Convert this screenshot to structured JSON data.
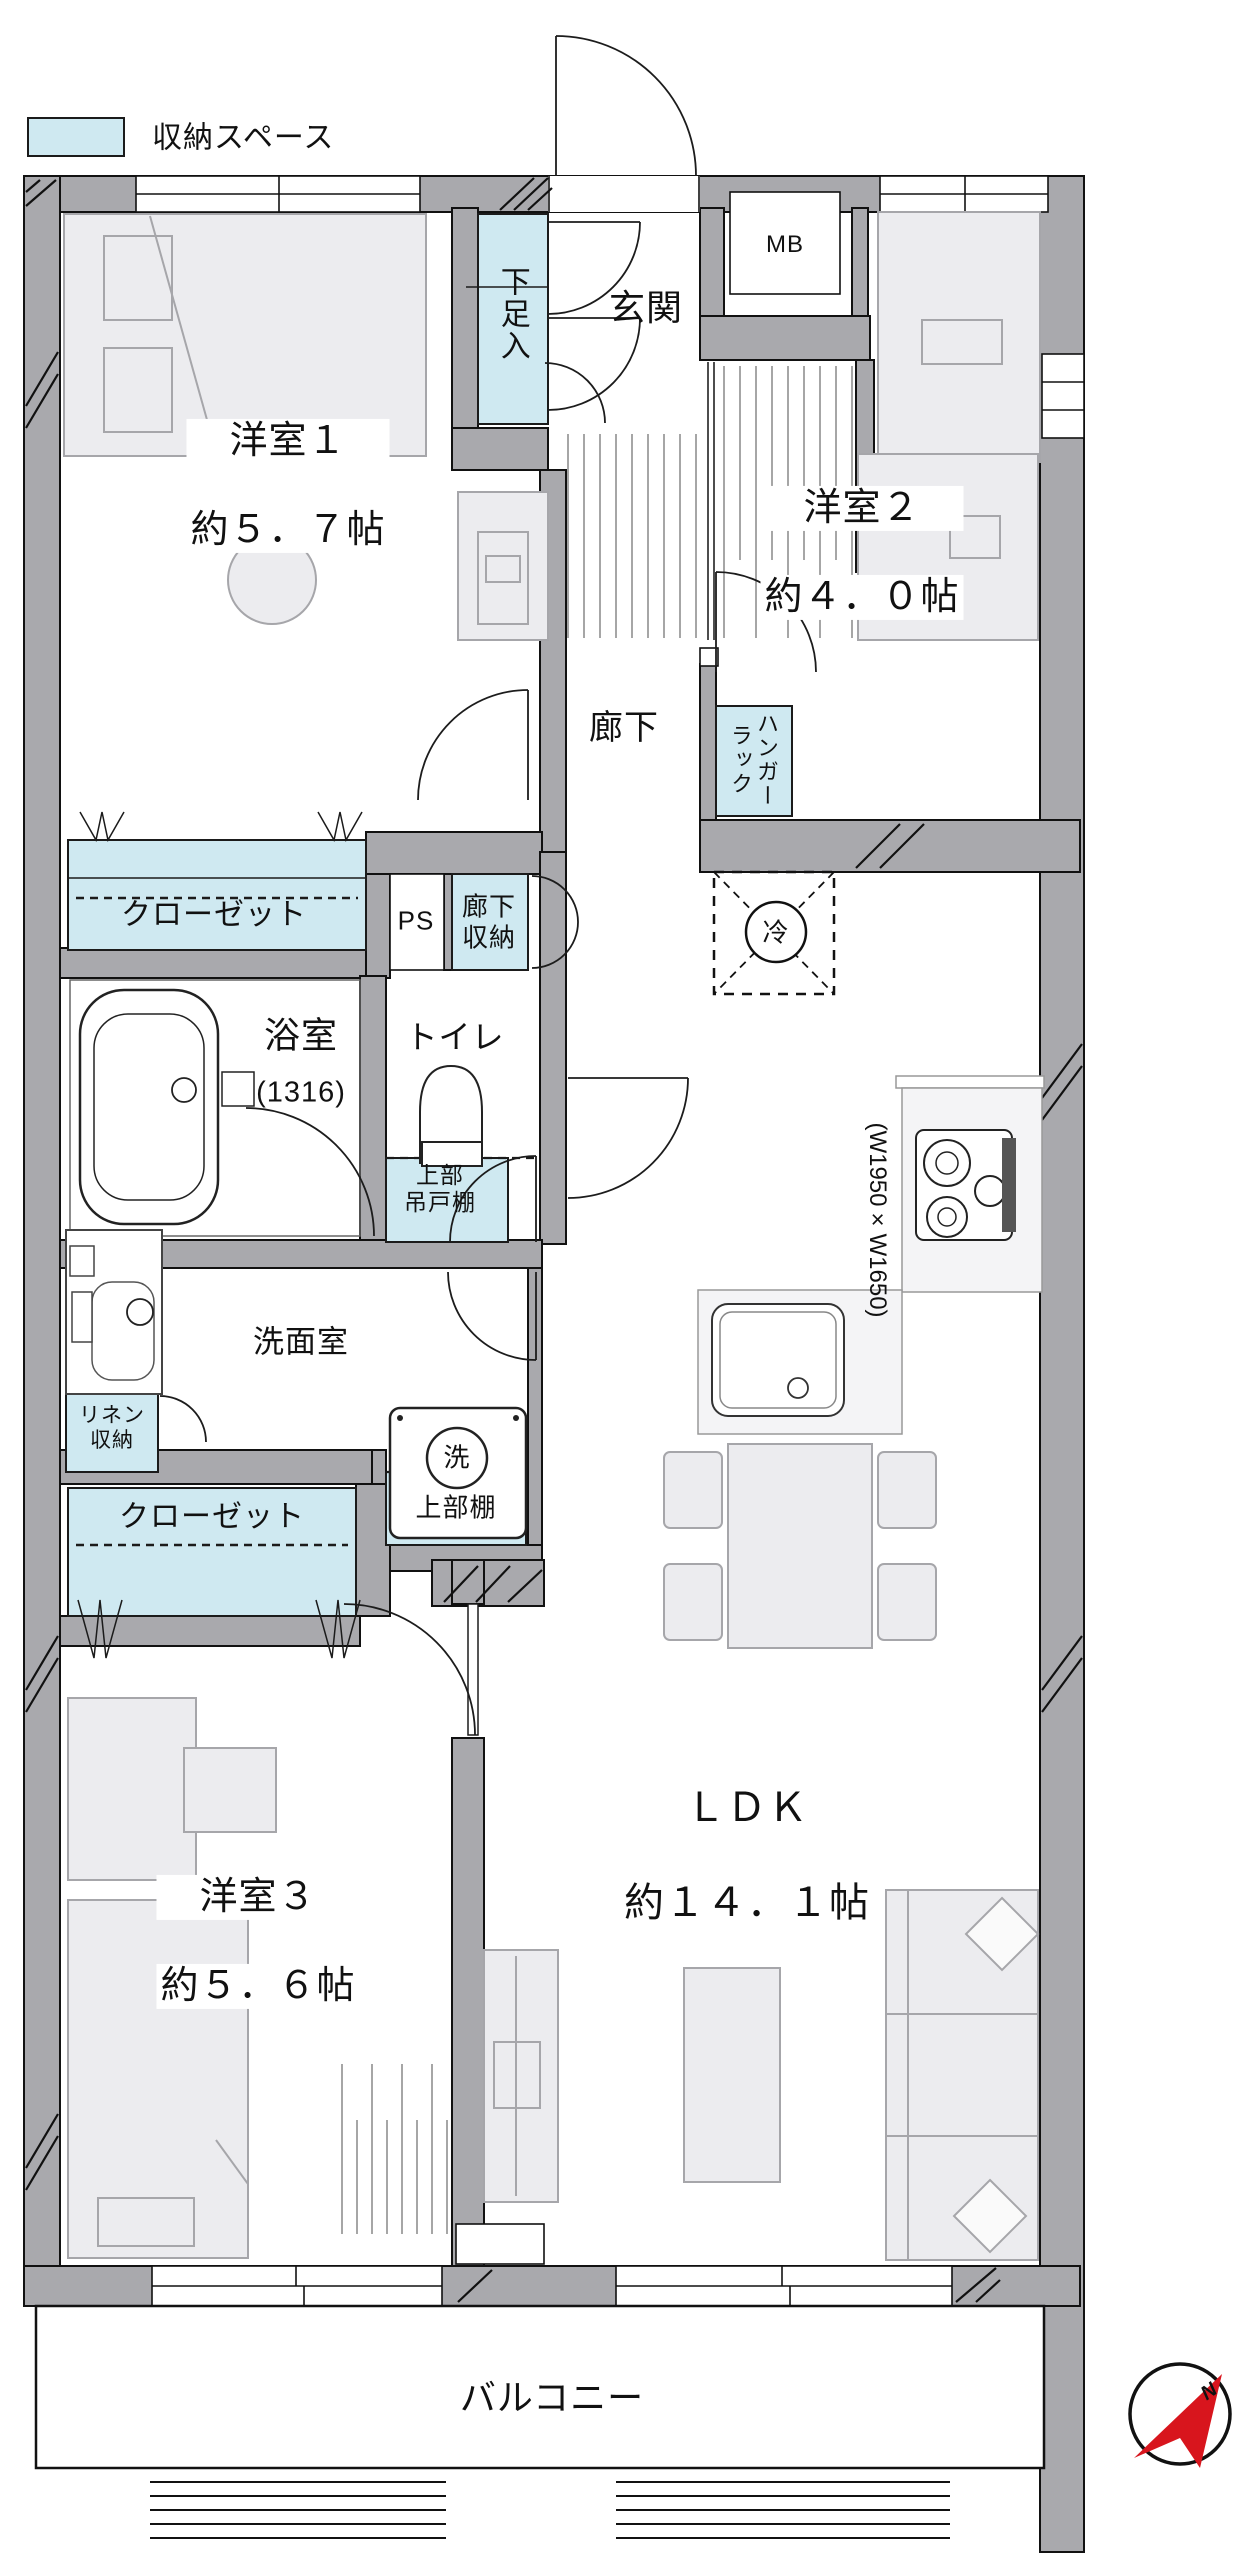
{
  "colors": {
    "storage_fill": "#cfe9f1",
    "wall_fill": "#a9a9ad",
    "furniture_fill": "#ececef",
    "compass_red": "#d8151d"
  },
  "legend": {
    "storage_label": "収納スペース"
  },
  "rooms": {
    "room1": {
      "name": "洋室１",
      "size": "約５．７帖"
    },
    "room2": {
      "name": "洋室２",
      "size": "約４．０帖"
    },
    "room3": {
      "name": "洋室３",
      "size": "約５．６帖"
    },
    "ldk": {
      "name": "ＬＤＫ",
      "size": "約１４．１帖"
    },
    "entrance": "玄関",
    "hallway": "廊下",
    "bathroom": {
      "name": "浴室",
      "size": "(1316)"
    },
    "toilet": "トイレ",
    "washroom": "洗面室",
    "balcony": "バルコニー"
  },
  "storage": {
    "shoe_cabinet": "下足入",
    "closet_room1": "クローゼット",
    "closet_room3": "クローゼット",
    "hallway_storage": "廊下\n収納",
    "hanger_rack": "ハンガー\nラック",
    "linen_storage": "リネン\n収納",
    "upper_hanging_cabinet": "上部\n吊戸棚",
    "upper_shelf": "上部棚"
  },
  "labels": {
    "meter_box": "MB",
    "pipe_space": "PS",
    "refrigerator": "冷",
    "washing_machine": "洗",
    "kitchen_dimensions": "(W1950×W1650)",
    "compass_north": "N"
  }
}
